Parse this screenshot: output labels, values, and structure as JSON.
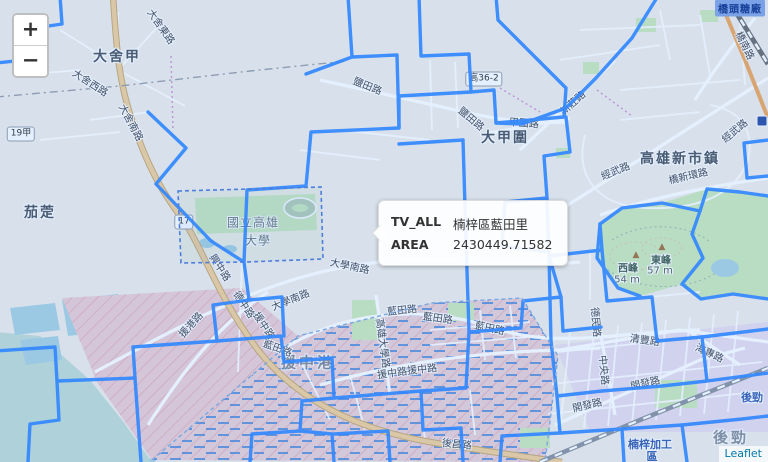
{
  "map": {
    "controls": {
      "zoom_in": "+",
      "zoom_out": "−"
    },
    "attribution": {
      "link_label": "Leaflet"
    },
    "tooltip": {
      "rows": [
        {
          "label": "TV_ALL",
          "value": "楠梓區藍田里"
        },
        {
          "label": "AREA",
          "value": "2430449.71582"
        }
      ]
    },
    "colors": {
      "boundary_blue": "#3388ff",
      "overlay_tint": "rgba(51,136,255,0.13)",
      "poi_blue": "#3b5fae",
      "attrib_link": "#0078A8",
      "water": "#aad3df",
      "park_green": "#cdeabb",
      "major_road": "#f2d09a"
    },
    "shields": [
      {
        "text": "19甲",
        "x": 21,
        "y": 134,
        "kind": "ref"
      },
      {
        "text": "17",
        "x": 184,
        "y": 222,
        "kind": "ref"
      },
      {
        "text": "高36-2",
        "x": 484,
        "y": 79,
        "kind": "ref"
      },
      {
        "text": "橋頭糖廠",
        "x": 740,
        "y": 8,
        "kind": "station"
      },
      {
        "text": "",
        "x": 762,
        "y": 121,
        "kind": "transit"
      }
    ],
    "labels": [
      {
        "text": "大舍甲",
        "x": 117,
        "y": 56,
        "rot": 0,
        "kind": "place"
      },
      {
        "text": "茄萣",
        "x": 40,
        "y": 212,
        "rot": 0,
        "kind": "place"
      },
      {
        "text": "高雄新市鎮",
        "x": 680,
        "y": 158,
        "rot": 0,
        "kind": "place"
      },
      {
        "text": "大甲圍",
        "x": 505,
        "y": 137,
        "rot": 0,
        "kind": "place"
      },
      {
        "text": "援中港",
        "x": 308,
        "y": 362,
        "rot": 0,
        "kind": "place-dim"
      },
      {
        "text": "後勁",
        "x": 731,
        "y": 437,
        "rot": 0,
        "kind": "place-dim"
      },
      {
        "text": "國立高雄",
        "x": 253,
        "y": 222,
        "rot": 0,
        "kind": "campus"
      },
      {
        "text": "大學",
        "x": 258,
        "y": 240,
        "rot": 0,
        "kind": "campus"
      },
      {
        "text": "後勁",
        "x": 752,
        "y": 397,
        "rot": 0,
        "kind": "poi"
      },
      {
        "text": "楠梓加工",
        "x": 650,
        "y": 444,
        "rot": 0,
        "kind": "poi"
      },
      {
        "text": "區",
        "x": 652,
        "y": 456,
        "rot": 0,
        "kind": "poi"
      },
      {
        "text": "▲",
        "x": 636,
        "y": 255,
        "rot": 0,
        "kind": "peak-icon"
      },
      {
        "text": "西峰",
        "x": 628,
        "y": 267,
        "rot": 0,
        "kind": "peak"
      },
      {
        "text": "54 m",
        "x": 627,
        "y": 280,
        "rot": 0,
        "kind": "peak-elev"
      },
      {
        "text": "▲",
        "x": 662,
        "y": 247,
        "rot": 0,
        "kind": "peak-icon"
      },
      {
        "text": "東峰",
        "x": 661,
        "y": 259,
        "rot": 0,
        "kind": "peak"
      },
      {
        "text": "57 m",
        "x": 660,
        "y": 271,
        "rot": 0,
        "kind": "peak-elev"
      },
      {
        "text": "鹽田路",
        "x": 368,
        "y": 85,
        "rot": 22,
        "kind": "road"
      },
      {
        "text": "鹽田路",
        "x": 472,
        "y": 118,
        "rot": 40,
        "kind": "road"
      },
      {
        "text": "甲圍路",
        "x": 524,
        "y": 122,
        "rot": 5,
        "kind": "road"
      },
      {
        "text": "新莊路",
        "x": 572,
        "y": 102,
        "rot": -42,
        "kind": "road"
      },
      {
        "text": "經武路",
        "x": 615,
        "y": 170,
        "rot": -22,
        "kind": "road"
      },
      {
        "text": "經武路",
        "x": 734,
        "y": 130,
        "rot": -40,
        "kind": "road"
      },
      {
        "text": "橋新環路",
        "x": 688,
        "y": 175,
        "rot": -13,
        "kind": "road"
      },
      {
        "text": "橋南路",
        "x": 746,
        "y": 45,
        "rot": 64,
        "kind": "road"
      },
      {
        "text": "大舍西路",
        "x": 91,
        "y": 82,
        "rot": 33,
        "kind": "road"
      },
      {
        "text": "大舍南路",
        "x": 132,
        "y": 122,
        "rot": 62,
        "kind": "road"
      },
      {
        "text": "大舍東路",
        "x": 162,
        "y": 26,
        "rot": 55,
        "kind": "road"
      },
      {
        "text": "大學南路",
        "x": 350,
        "y": 265,
        "rot": 12,
        "kind": "road"
      },
      {
        "text": "大學南路",
        "x": 290,
        "y": 299,
        "rot": -22,
        "kind": "road"
      },
      {
        "text": "藍田路",
        "x": 402,
        "y": 309,
        "rot": -6,
        "kind": "road"
      },
      {
        "text": "藍田路",
        "x": 438,
        "y": 317,
        "rot": 8,
        "kind": "road"
      },
      {
        "text": "藍田路",
        "x": 490,
        "y": 327,
        "rot": 12,
        "kind": "road"
      },
      {
        "text": "藍田路",
        "x": 278,
        "y": 347,
        "rot": 20,
        "kind": "road"
      },
      {
        "text": "高雄大學路",
        "x": 384,
        "y": 343,
        "rot": 82,
        "kind": "road"
      },
      {
        "text": "援中路",
        "x": 392,
        "y": 372,
        "rot": -8,
        "kind": "road"
      },
      {
        "text": "援中路",
        "x": 422,
        "y": 368,
        "rot": -6,
        "kind": "road"
      },
      {
        "text": "興中路",
        "x": 221,
        "y": 267,
        "rot": 57,
        "kind": "road"
      },
      {
        "text": "德中路",
        "x": 245,
        "y": 304,
        "rot": 57,
        "kind": "road"
      },
      {
        "text": "援中路",
        "x": 265,
        "y": 325,
        "rot": 57,
        "kind": "road"
      },
      {
        "text": "援港路",
        "x": 190,
        "y": 324,
        "rot": -48,
        "kind": "road"
      },
      {
        "text": "德民路",
        "x": 597,
        "y": 322,
        "rot": 85,
        "kind": "road"
      },
      {
        "text": "清豐路",
        "x": 645,
        "y": 339,
        "rot": 8,
        "kind": "road"
      },
      {
        "text": "海專路",
        "x": 710,
        "y": 352,
        "rot": 25,
        "kind": "road"
      },
      {
        "text": "中央路",
        "x": 605,
        "y": 370,
        "rot": 85,
        "kind": "road"
      },
      {
        "text": "開發路",
        "x": 645,
        "y": 382,
        "rot": -13,
        "kind": "road"
      },
      {
        "text": "開發路",
        "x": 587,
        "y": 404,
        "rot": -13,
        "kind": "road"
      },
      {
        "text": "後昌路",
        "x": 457,
        "y": 443,
        "rot": 6,
        "kind": "road"
      }
    ]
  }
}
